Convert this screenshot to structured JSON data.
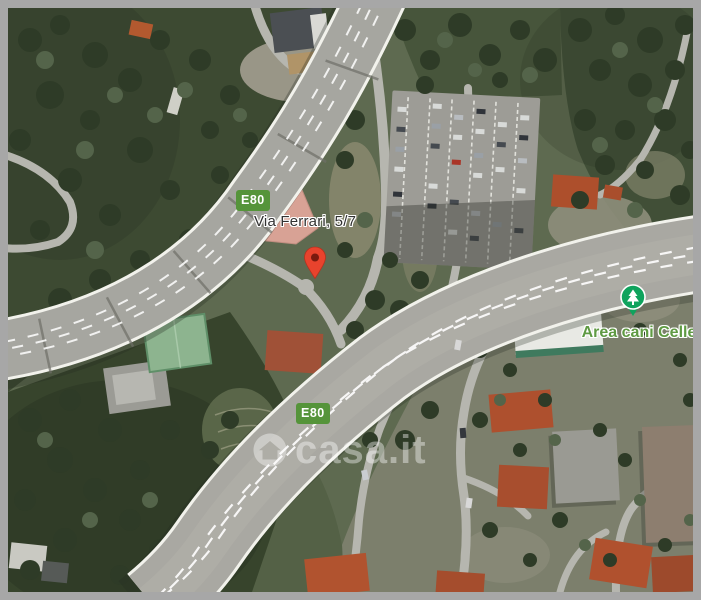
{
  "frame": {
    "color": "#a7a7a7"
  },
  "map": {
    "type": "satellite",
    "address_label": "Via Ferrari, 5/7",
    "route_badges": [
      {
        "label": "E80",
        "color": "#55943a"
      },
      {
        "label": "E80",
        "color": "#55943a"
      }
    ],
    "poi": {
      "label": "Area cani Celle",
      "icon": "park-tree-icon",
      "icon_color": "#0fa35d",
      "label_color": "#5f9a43"
    },
    "marker": {
      "icon": "red-map-pin",
      "color": "#e8432d"
    },
    "watermark": {
      "text": "casa.it",
      "logo": "casa-it-ring-logo",
      "color": "#ffffff",
      "opacity": 0.4
    }
  }
}
